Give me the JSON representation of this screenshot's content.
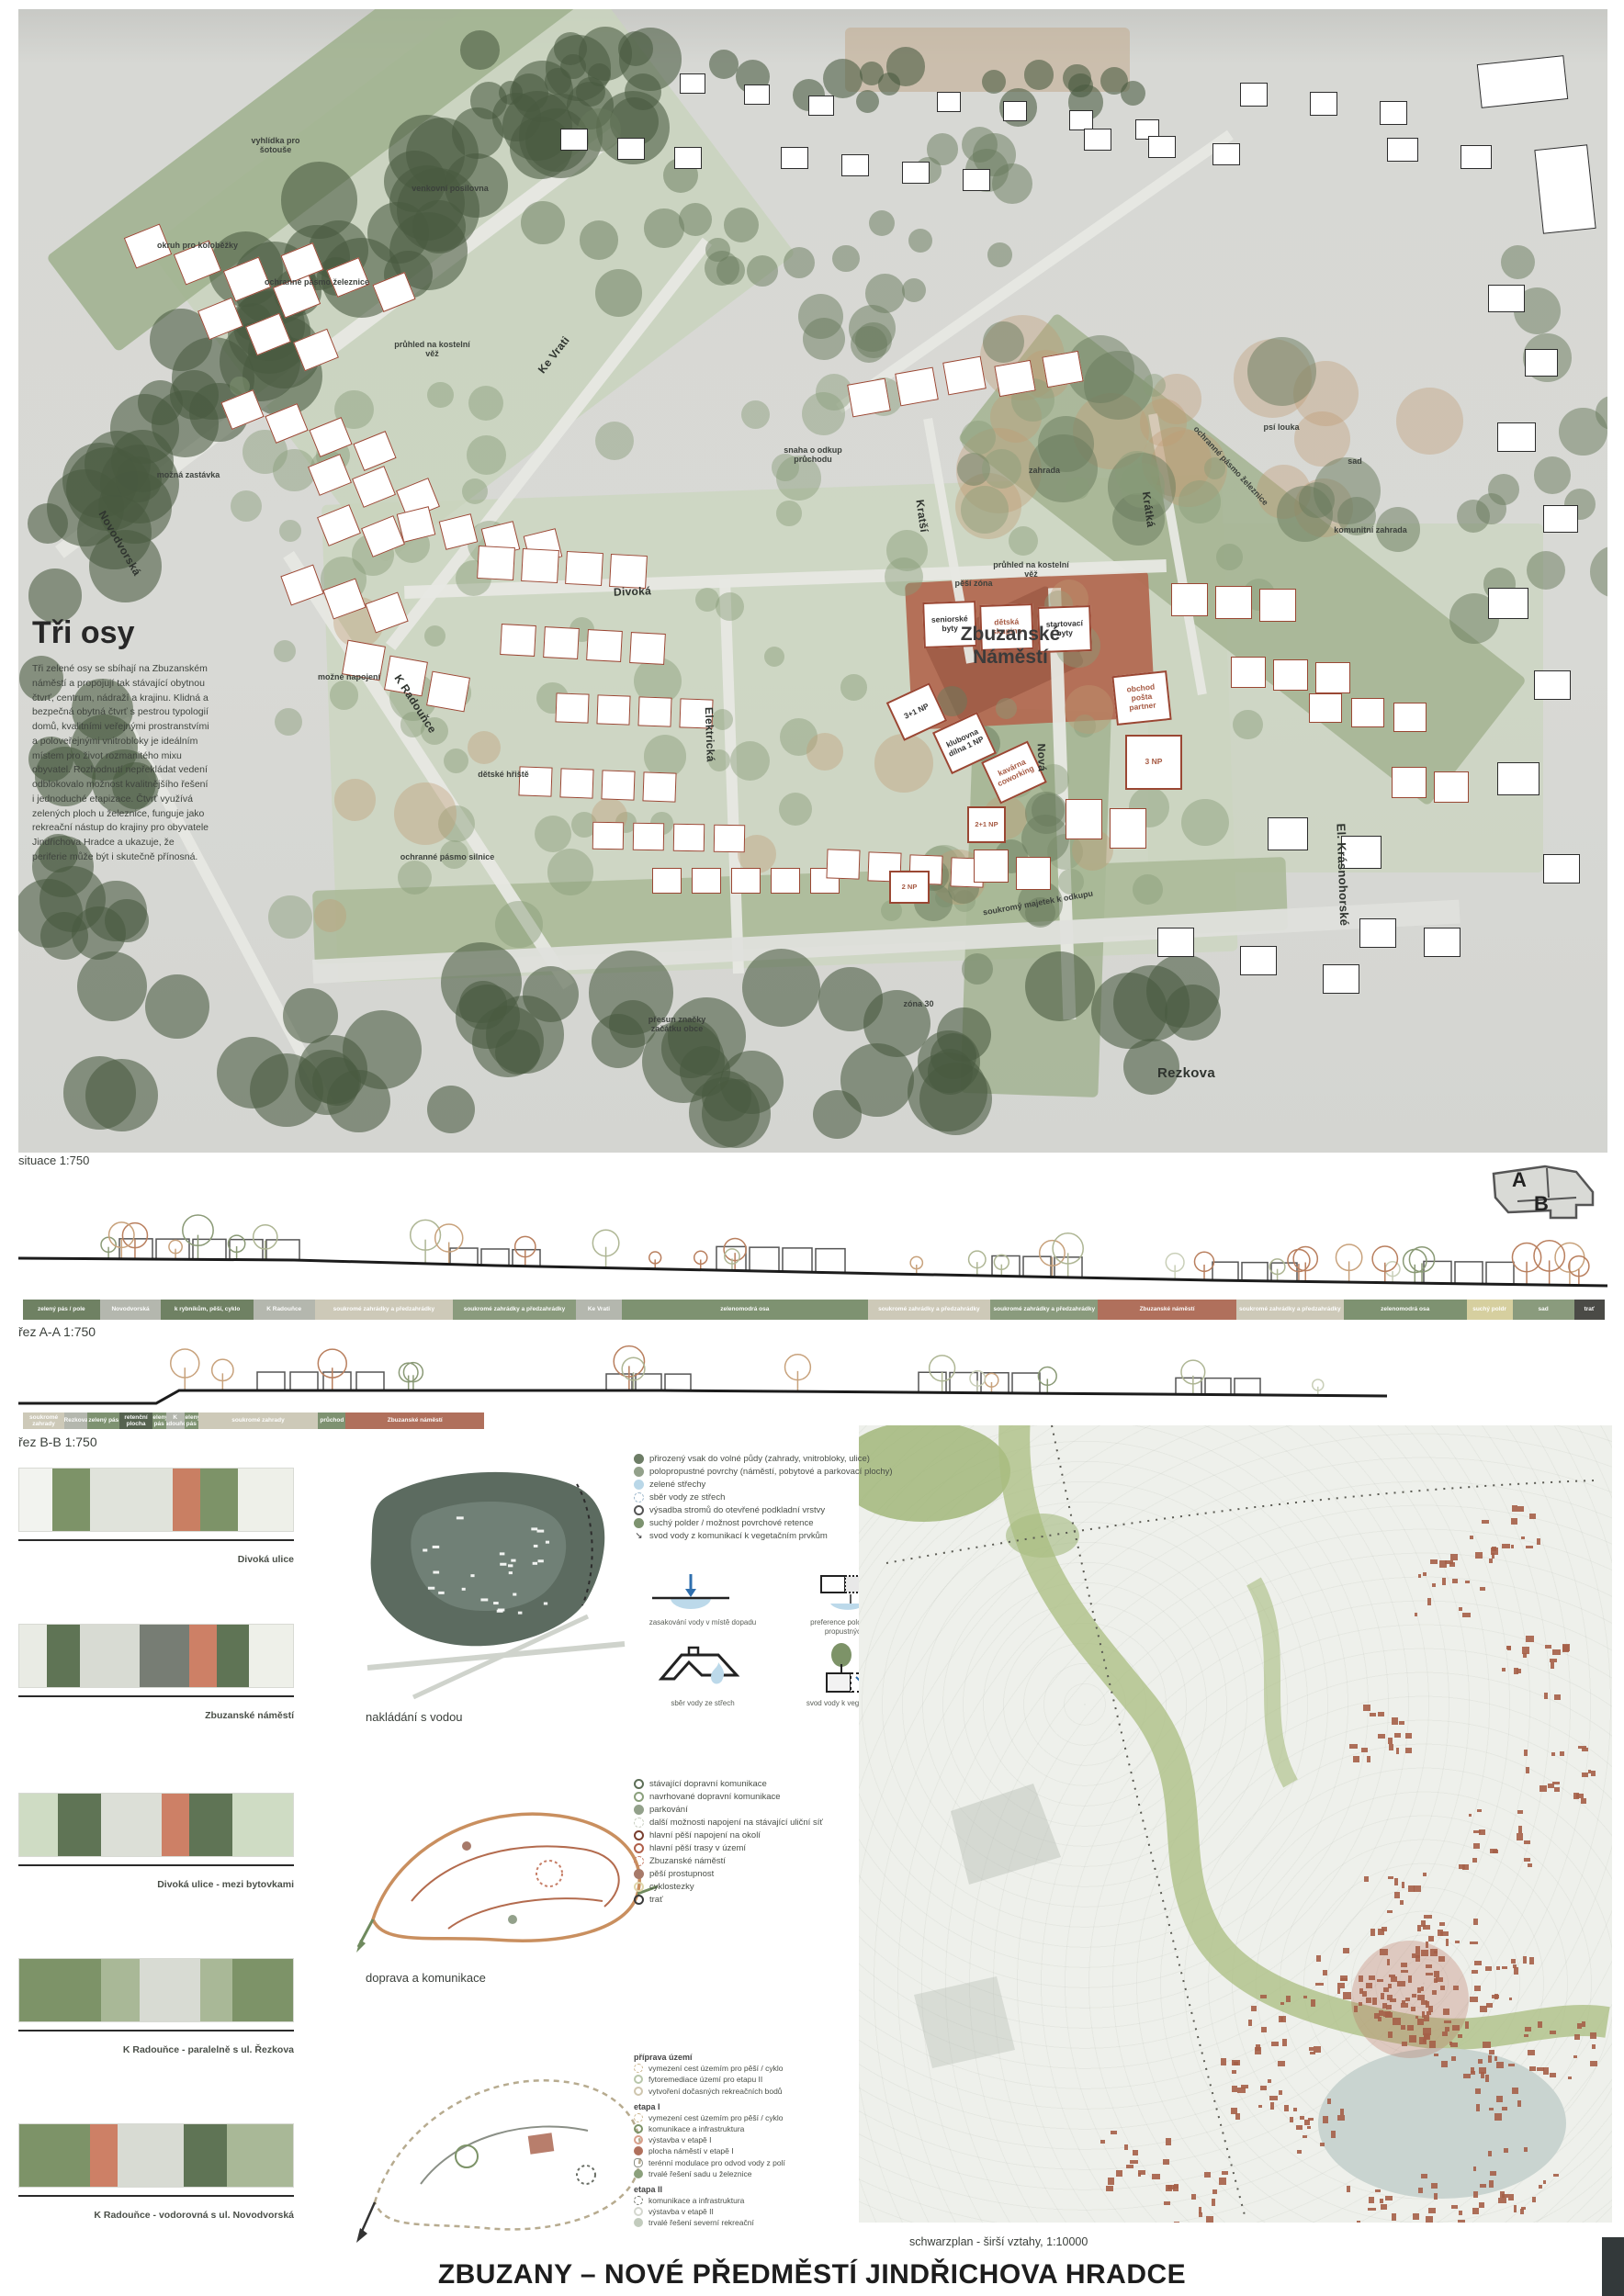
{
  "poster": {
    "title": "ZBUZANY – NOVÉ PŘEDMĚSTÍ JINDŘICHOVA HRADCE"
  },
  "intro": {
    "heading": "Tři osy",
    "body": "Tři zelené osy se sbíhají na Zbuzanském náměstí a propojují tak stávající obytnou čtvrť, centrum, nádraží a krajinu. Klidná a bezpečná obytná čtvrť s pestrou typologií domů, kvalitními veřejnými prostranstvími a poloveřejnými vnitrobloky je ideálním místem pro život rozmanitého mixu obyvatel. Rozhodnutí nepřekládat vedení odblokovalo možnost kvalitnějšího řešení i jednoduché etapizace. Čtvrť využívá zelených ploch u železnice, funguje jako rekreační nástup do krajiny pro obyvatele Jindřichova Hradce a ukazuje, že periferie může být i skutečně přínosná."
  },
  "siteplan": {
    "caption": "situace 1:750",
    "square": "Zbuzanské Náměstí",
    "streets": {
      "novodvorska": "Novodvorská",
      "ke_vrati": "Ke Vrati",
      "k_radounce": "K Radouňce",
      "divoka": "Divoká",
      "kratsi": "Kratší",
      "kratka": "Krátká",
      "elektricka": "Elektrická",
      "nova": "Nová",
      "rezkova": "Rezkova",
      "krasnohorske": "El. Krásnohorské"
    },
    "areas": {
      "vyhlidka": "vyhlídka pro šotouše",
      "posilovna": "venkovní posilovna",
      "okruh": "okruh pro koloběžky",
      "pasmo_zeleznice": "ochranné pásmo železnice",
      "pasmo_zeleznice2": "ochranné pásmo železnice",
      "odkup_pruchodu": "snaha o odkup průchodu",
      "zahrada": "zahrada",
      "psi_louka": "psí louka",
      "sad": "sad",
      "komunitni_zahrada": "komunitní zahrada",
      "pesi_zona": "pěší zóna",
      "pruhled": "průhled na kostelní věž",
      "pruhled2": "průhled na kostelní věž",
      "mozne_napojeni": "možné napojení",
      "mozna_zastavka": "možná zastávka",
      "detske_hriste": "dětské hřiště",
      "soukromy_majetek": "soukromý majetek k odkupu",
      "presun_znacky": "přesun značky začátku obce",
      "pasmo_silnice": "ochranné pásmo silnice",
      "zona30": "zóna 30"
    },
    "buildings": {
      "seniorske": "seniorské byty",
      "detska": "dětská skupina",
      "startovaci": "startovací byty",
      "np31": "3+1 NP",
      "klubovna": "klubovna dílna 1 NP",
      "kavarna": "kavárna coworking",
      "obchod": "obchod pošta partner",
      "np3": "3 NP",
      "np21": "2+1 NP",
      "np2": "2 NP"
    }
  },
  "keymap": {
    "a": "A",
    "b": "B"
  },
  "section_a": {
    "caption": "řez A-A 1:750",
    "bands": [
      {
        "label": "zelený pás / pole",
        "color": "#6f8163",
        "w": 5
      },
      {
        "label": "Novodvorská",
        "color": "#b4b7ae",
        "w": 4
      },
      {
        "label": "k rybníkům, pěší, cyklo",
        "color": "#6f8163",
        "w": 6
      },
      {
        "label": "K Radouňce",
        "color": "#b4b7ae",
        "w": 4
      },
      {
        "label": "soukromé zahrádky a předzahrádky",
        "color": "#cdc9b8",
        "w": 9
      },
      {
        "label": "soukromé zahrádky a předzahrádky",
        "color": "#8a9b7d",
        "w": 8
      },
      {
        "label": "Ke Vrati",
        "color": "#b4b7ae",
        "w": 3
      },
      {
        "label": "zelenomodrá osa",
        "color": "#7e9271",
        "w": 16
      },
      {
        "label": "soukromé zahrádky a předzahrádky",
        "color": "#cdc9b8",
        "w": 8
      },
      {
        "label": "soukromé zahrádky a předzahrádky",
        "color": "#8a9b7d",
        "w": 7
      },
      {
        "label": "Zbuzanské náměstí",
        "color": "#b0705c",
        "w": 9
      },
      {
        "label": "soukromé zahrádky a předzahrádky",
        "color": "#cdc9b8",
        "w": 7
      },
      {
        "label": "zelenomodrá osa",
        "color": "#7e9271",
        "w": 8
      },
      {
        "label": "suchý poldr",
        "color": "#d6cf9f",
        "w": 3
      },
      {
        "label": "sad",
        "color": "#8a9b7d",
        "w": 4
      },
      {
        "label": "trať",
        "color": "#4a4a46",
        "w": 2
      }
    ]
  },
  "section_b": {
    "caption": "řez B-B 1:750",
    "bands": [
      {
        "label": "soukromé zahrady",
        "color": "#cdc9b8",
        "w": 9
      },
      {
        "label": "Rezkova",
        "color": "#b4b7ae",
        "w": 5
      },
      {
        "label": "zelený pás",
        "color": "#7e9271",
        "w": 7
      },
      {
        "label": "retenční plocha",
        "color": "#55624f",
        "w": 7
      },
      {
        "label": "zelený pás",
        "color": "#7e9271",
        "w": 3
      },
      {
        "label": "K Radouňce",
        "color": "#b4b7ae",
        "w": 4
      },
      {
        "label": "zelený pás",
        "color": "#7e9271",
        "w": 3
      },
      {
        "label": "soukromé zahrady",
        "color": "#cdc9b8",
        "w": 26
      },
      {
        "label": "průchod",
        "color": "#7e9271",
        "w": 6
      },
      {
        "label": "Zbuzanské náměstí",
        "color": "#b0705c",
        "w": 30
      }
    ]
  },
  "street_sections": {
    "items": [
      {
        "caption": "Divoká ulice",
        "bands": [
          [
            "#f2f3ef",
            12
          ],
          [
            "#7d9368",
            14
          ],
          [
            "#e0e3db",
            30
          ],
          [
            "#c97f63",
            10
          ],
          [
            "#7d9368",
            14
          ],
          [
            "#eef0e9",
            20
          ]
        ]
      },
      {
        "caption": "Zbuzanské náměstí",
        "bands": [
          [
            "#e9ebe4",
            10
          ],
          [
            "#5f7455",
            12
          ],
          [
            "#d8dbd3",
            22
          ],
          [
            "#777d74",
            18
          ],
          [
            "#cd8066",
            10
          ],
          [
            "#5f7455",
            12
          ],
          [
            "#eef0e9",
            16
          ]
        ]
      },
      {
        "caption": "Divoká ulice - mezi bytovkami",
        "bands": [
          [
            "#cfdcc4",
            14
          ],
          [
            "#5f7455",
            16
          ],
          [
            "#dcdfd7",
            22
          ],
          [
            "#cd8066",
            10
          ],
          [
            "#5f7455",
            16
          ],
          [
            "#cfdcc4",
            22
          ]
        ]
      },
      {
        "caption": "K Radouňce - paralelně s ul. Řezkova",
        "bands": [
          [
            "#7d9368",
            30
          ],
          [
            "#a9b897",
            14
          ],
          [
            "#d8dbd3",
            22
          ],
          [
            "#a9b897",
            12
          ],
          [
            "#7d9368",
            22
          ]
        ]
      },
      {
        "caption": "K Radouňce - vodorovná s ul. Novodvorská",
        "bands": [
          [
            "#7d9368",
            26
          ],
          [
            "#cd8066",
            10
          ],
          [
            "#d8dbd3",
            24
          ],
          [
            "#5f7455",
            16
          ],
          [
            "#a9b897",
            24
          ]
        ]
      }
    ]
  },
  "water": {
    "caption": "nakládání s vodou",
    "legend": [
      {
        "label": "přirozený vsak do volné půdy (zahrady, vnitrobloky, ulice)",
        "marker": "filled",
        "color": "#6d7d66"
      },
      {
        "label": "polopropustné povrchy (náměstí, pobytové a parkovací plochy)",
        "marker": "filled",
        "color": "#93a18b"
      },
      {
        "label": "zelené střechy",
        "marker": "filled",
        "color": "#b9d7e8"
      },
      {
        "label": "sběr vody ze střech",
        "marker": "dashed",
        "color": "#9fb9cc"
      },
      {
        "label": "výsadba stromů do otevřené podkladní vrstvy",
        "marker": "ring",
        "color": "#555555"
      },
      {
        "label": "suchý polder / možnost povrchové retence",
        "marker": "filled",
        "color": "#7d9370"
      },
      {
        "label": "svod vody z komunikací k vegetačním prvkům",
        "marker": "arrow",
        "color": "#333333"
      }
    ],
    "diagrams": [
      {
        "label": "zasakování vody v místě dopadu"
      },
      {
        "label": "preference polopropustných a propustných povrchů"
      },
      {
        "label": "sběr vody ze střech"
      },
      {
        "label": "svod vody k vegetačním prvkům"
      }
    ]
  },
  "transport": {
    "caption": "doprava a komunikace",
    "legend": [
      {
        "label": "stávající dopravní komunikace",
        "marker": "ring",
        "color": "#5d6f57"
      },
      {
        "label": "navrhované dopravní komunikace",
        "marker": "ring",
        "color": "#8ba07c"
      },
      {
        "label": "parkování",
        "marker": "filled",
        "color": "#93a18b"
      },
      {
        "label": "další možnosti napojení na stávající uliční síť",
        "marker": "dashed",
        "color": "#c9cfc2"
      },
      {
        "label": "hlavní pěší napojení na okolí",
        "marker": "ring",
        "color": "#7a3f2f"
      },
      {
        "label": "hlavní pěší trasy v území",
        "marker": "ring",
        "color": "#b0604a"
      },
      {
        "label": "Zbuzanské náměstí",
        "marker": "dashed",
        "color": "#c77f68"
      },
      {
        "label": "pěší prostupnost",
        "marker": "filled",
        "color": "#a77a6a"
      },
      {
        "label": "cyklostezky",
        "marker": "ring",
        "color": "#e0d6ab"
      },
      {
        "label": "trať",
        "marker": "ring",
        "color": "#3a3a3a"
      }
    ]
  },
  "phasing": {
    "groups": [
      {
        "header": "příprava území",
        "items": [
          {
            "label": "vymezení cest územím pro pěší / cyklo",
            "marker": "dashed",
            "color": "#c9b38a"
          },
          {
            "label": "fytoremediace území pro etapu II",
            "marker": "ring",
            "color": "#b9c7ab"
          },
          {
            "label": "vytvoření dočasných rekreačních bodů",
            "marker": "ring",
            "color": "#cfc6ae"
          }
        ]
      },
      {
        "header": "etapa I",
        "items": [
          {
            "label": "vymezení cest územím pro pěší / cyklo",
            "marker": "dashed",
            "color": "#c9b38a"
          },
          {
            "label": "komunikace a infrastruktura",
            "marker": "ring",
            "color": "#7d9368"
          },
          {
            "label": "výstavba v etapě I",
            "marker": "ring",
            "color": "#d8a08c"
          },
          {
            "label": "plocha náměstí v etapě I",
            "marker": "filled",
            "color": "#b0705c"
          },
          {
            "label": "terénní modulace pro odvod vody z polí",
            "marker": "blob",
            "color": "#8a8f86"
          },
          {
            "label": "trvalé řešení sadu u železnice",
            "marker": "filled",
            "color": "#8ba07c"
          }
        ]
      },
      {
        "header": "etapa II",
        "items": [
          {
            "label": "komunikace a infrastruktura",
            "marker": "dashed",
            "color": "#6a6f66"
          },
          {
            "label": "výstavba v etapě II",
            "marker": "ring",
            "color": "#d4d7cf"
          },
          {
            "label": "trvalé řešení severní rekreační",
            "marker": "filled",
            "color": "#c2cbbd"
          }
        ]
      }
    ]
  },
  "schwarzplan": {
    "caption": "schwarzplan - širší vztahy, 1:10000"
  }
}
